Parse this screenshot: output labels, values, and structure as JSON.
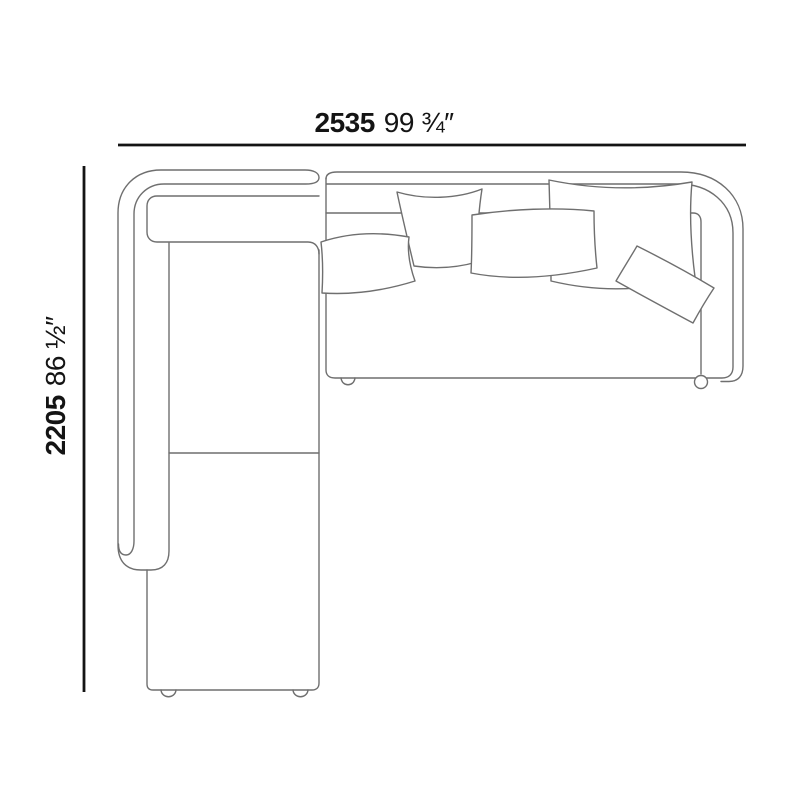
{
  "diagram": {
    "subject": "corner sectional sofa top view technical drawing",
    "width_dimension": {
      "metric": "2535",
      "imperial": "99 ¾″"
    },
    "depth_dimension": {
      "metric": "2205",
      "imperial": "86 ½″"
    },
    "colors": {
      "dimension": "#141414",
      "outline": "#6f6f6f",
      "pillow_fill": "#ffffff",
      "background": "#ffffff"
    }
  }
}
